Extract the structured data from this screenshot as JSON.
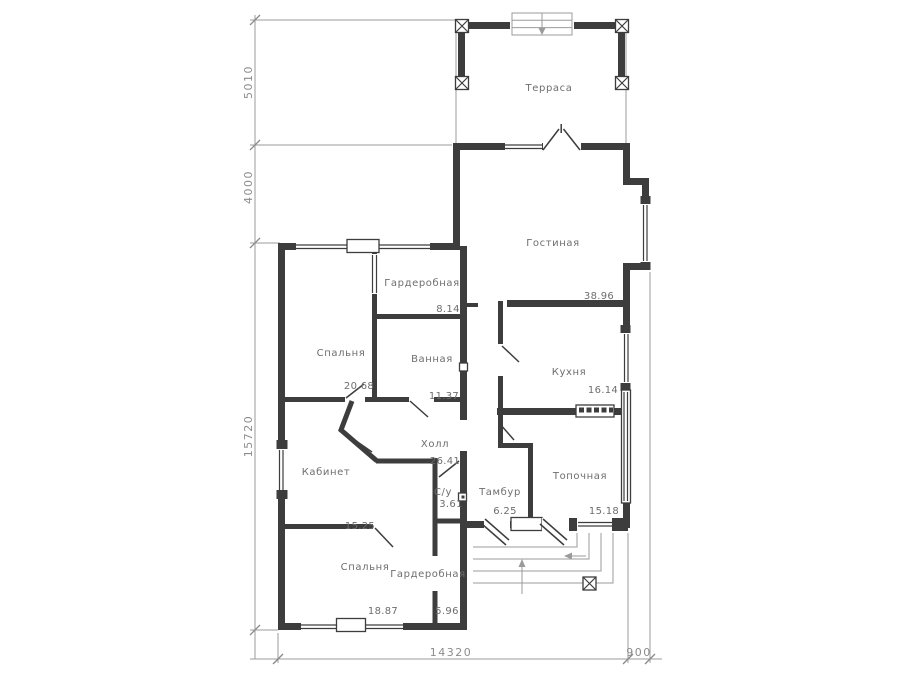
{
  "plan": {
    "title": "house-floor-plan",
    "rooms": [
      {
        "name": "terrace",
        "label": "Терраса",
        "area": ""
      },
      {
        "name": "living-room",
        "label": "Гостиная",
        "area": "38.96"
      },
      {
        "name": "kitchen",
        "label": "Кухня",
        "area": "16.14"
      },
      {
        "name": "bedroom-top",
        "label": "Спальня",
        "area": "20.68"
      },
      {
        "name": "wardrobe-top",
        "label": "Гардеробная",
        "area": "8.14"
      },
      {
        "name": "bathroom",
        "label": "Ванная",
        "area": "11.37"
      },
      {
        "name": "hall",
        "label": "Холл",
        "area": "26.41"
      },
      {
        "name": "office",
        "label": "Кабинет",
        "area": "15.25"
      },
      {
        "name": "wc",
        "label": "С/у",
        "area": "3.61"
      },
      {
        "name": "vestibule",
        "label": "Тамбур",
        "area": "6.25"
      },
      {
        "name": "boiler-room",
        "label": "Топочная",
        "area": "15.18"
      },
      {
        "name": "bedroom-bottom",
        "label": "Спальня",
        "area": "18.87"
      },
      {
        "name": "wardrobe-bottom",
        "label": "Гардеробная",
        "area": "5.96"
      }
    ],
    "dimensions": {
      "left": [
        {
          "value": "5010"
        },
        {
          "value": "4000"
        },
        {
          "value": "15720"
        }
      ],
      "bottom": [
        {
          "value": "14320"
        },
        {
          "value": "900"
        }
      ]
    },
    "colors": {
      "wall": "#3d3d3d",
      "lite": "#9b9b9b",
      "label": "#6e6e6e",
      "dimtext": "#8c8c8c",
      "bg": "#ffffff"
    }
  }
}
